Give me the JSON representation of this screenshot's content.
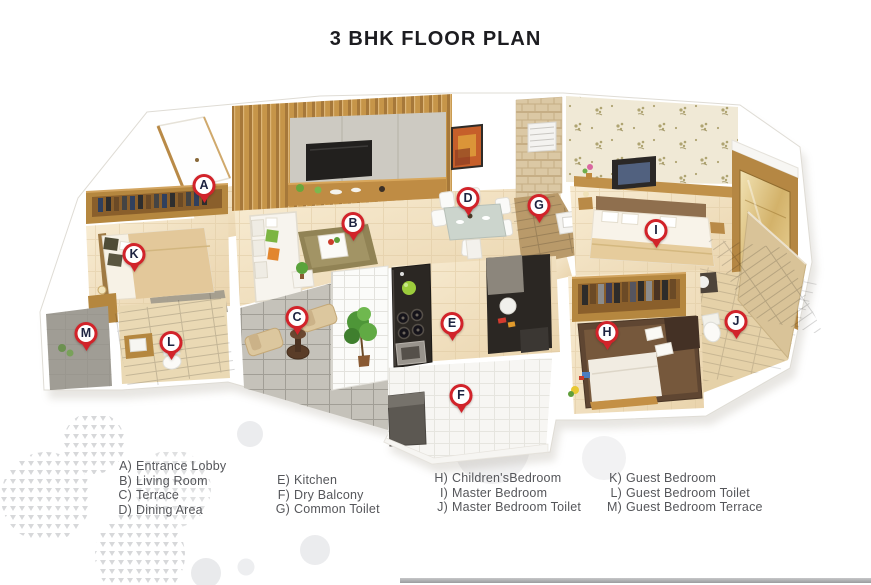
{
  "title": "3 BHK FLOOR PLAN",
  "plan": {
    "marker_style": {
      "ring_color": "#d2232a",
      "letter_color": "#1d2340",
      "fill": "#ffffff"
    },
    "markers": [
      {
        "letter": "A",
        "x": 204,
        "y": 186
      },
      {
        "letter": "B",
        "x": 353,
        "y": 224
      },
      {
        "letter": "C",
        "x": 297,
        "y": 318
      },
      {
        "letter": "D",
        "x": 468,
        "y": 199
      },
      {
        "letter": "E",
        "x": 452,
        "y": 324
      },
      {
        "letter": "F",
        "x": 461,
        "y": 396
      },
      {
        "letter": "G",
        "x": 539,
        "y": 206
      },
      {
        "letter": "H",
        "x": 607,
        "y": 333
      },
      {
        "letter": "I",
        "x": 656,
        "y": 231
      },
      {
        "letter": "J",
        "x": 736,
        "y": 322
      },
      {
        "letter": "K",
        "x": 134,
        "y": 255
      },
      {
        "letter": "L",
        "x": 171,
        "y": 343
      },
      {
        "letter": "M",
        "x": 86,
        "y": 334
      }
    ]
  },
  "legend": {
    "text_color": "#55565a",
    "title_color": "#1c1c20",
    "columns": [
      {
        "items": [
          {
            "key": "A)",
            "label": "Entrance Lobby"
          },
          {
            "key": "B)",
            "label": "Living Room"
          },
          {
            "key": "C)",
            "label": "Terrace"
          },
          {
            "key": "D)",
            "label": "Dining Area"
          }
        ]
      },
      {
        "items": [
          {
            "key": "E)",
            "label": "Kitchen"
          },
          {
            "key": "F)",
            "label": "Dry Balcony"
          },
          {
            "key": "G)",
            "label": "Common Toilet"
          }
        ]
      },
      {
        "items": [
          {
            "key": "H)",
            "label": "Children'sBedroom"
          },
          {
            "key": "I)",
            "label": "Master Bedroom"
          },
          {
            "key": "J)",
            "label": "Master Bedroom Toilet"
          }
        ]
      },
      {
        "items": [
          {
            "key": "K)",
            "label": "Guest Bedroom"
          },
          {
            "key": "L)",
            "label": "Guest Bedroom Toilet"
          },
          {
            "key": "M)",
            "label": "Guest Bedroom Terrace"
          }
        ]
      }
    ]
  }
}
